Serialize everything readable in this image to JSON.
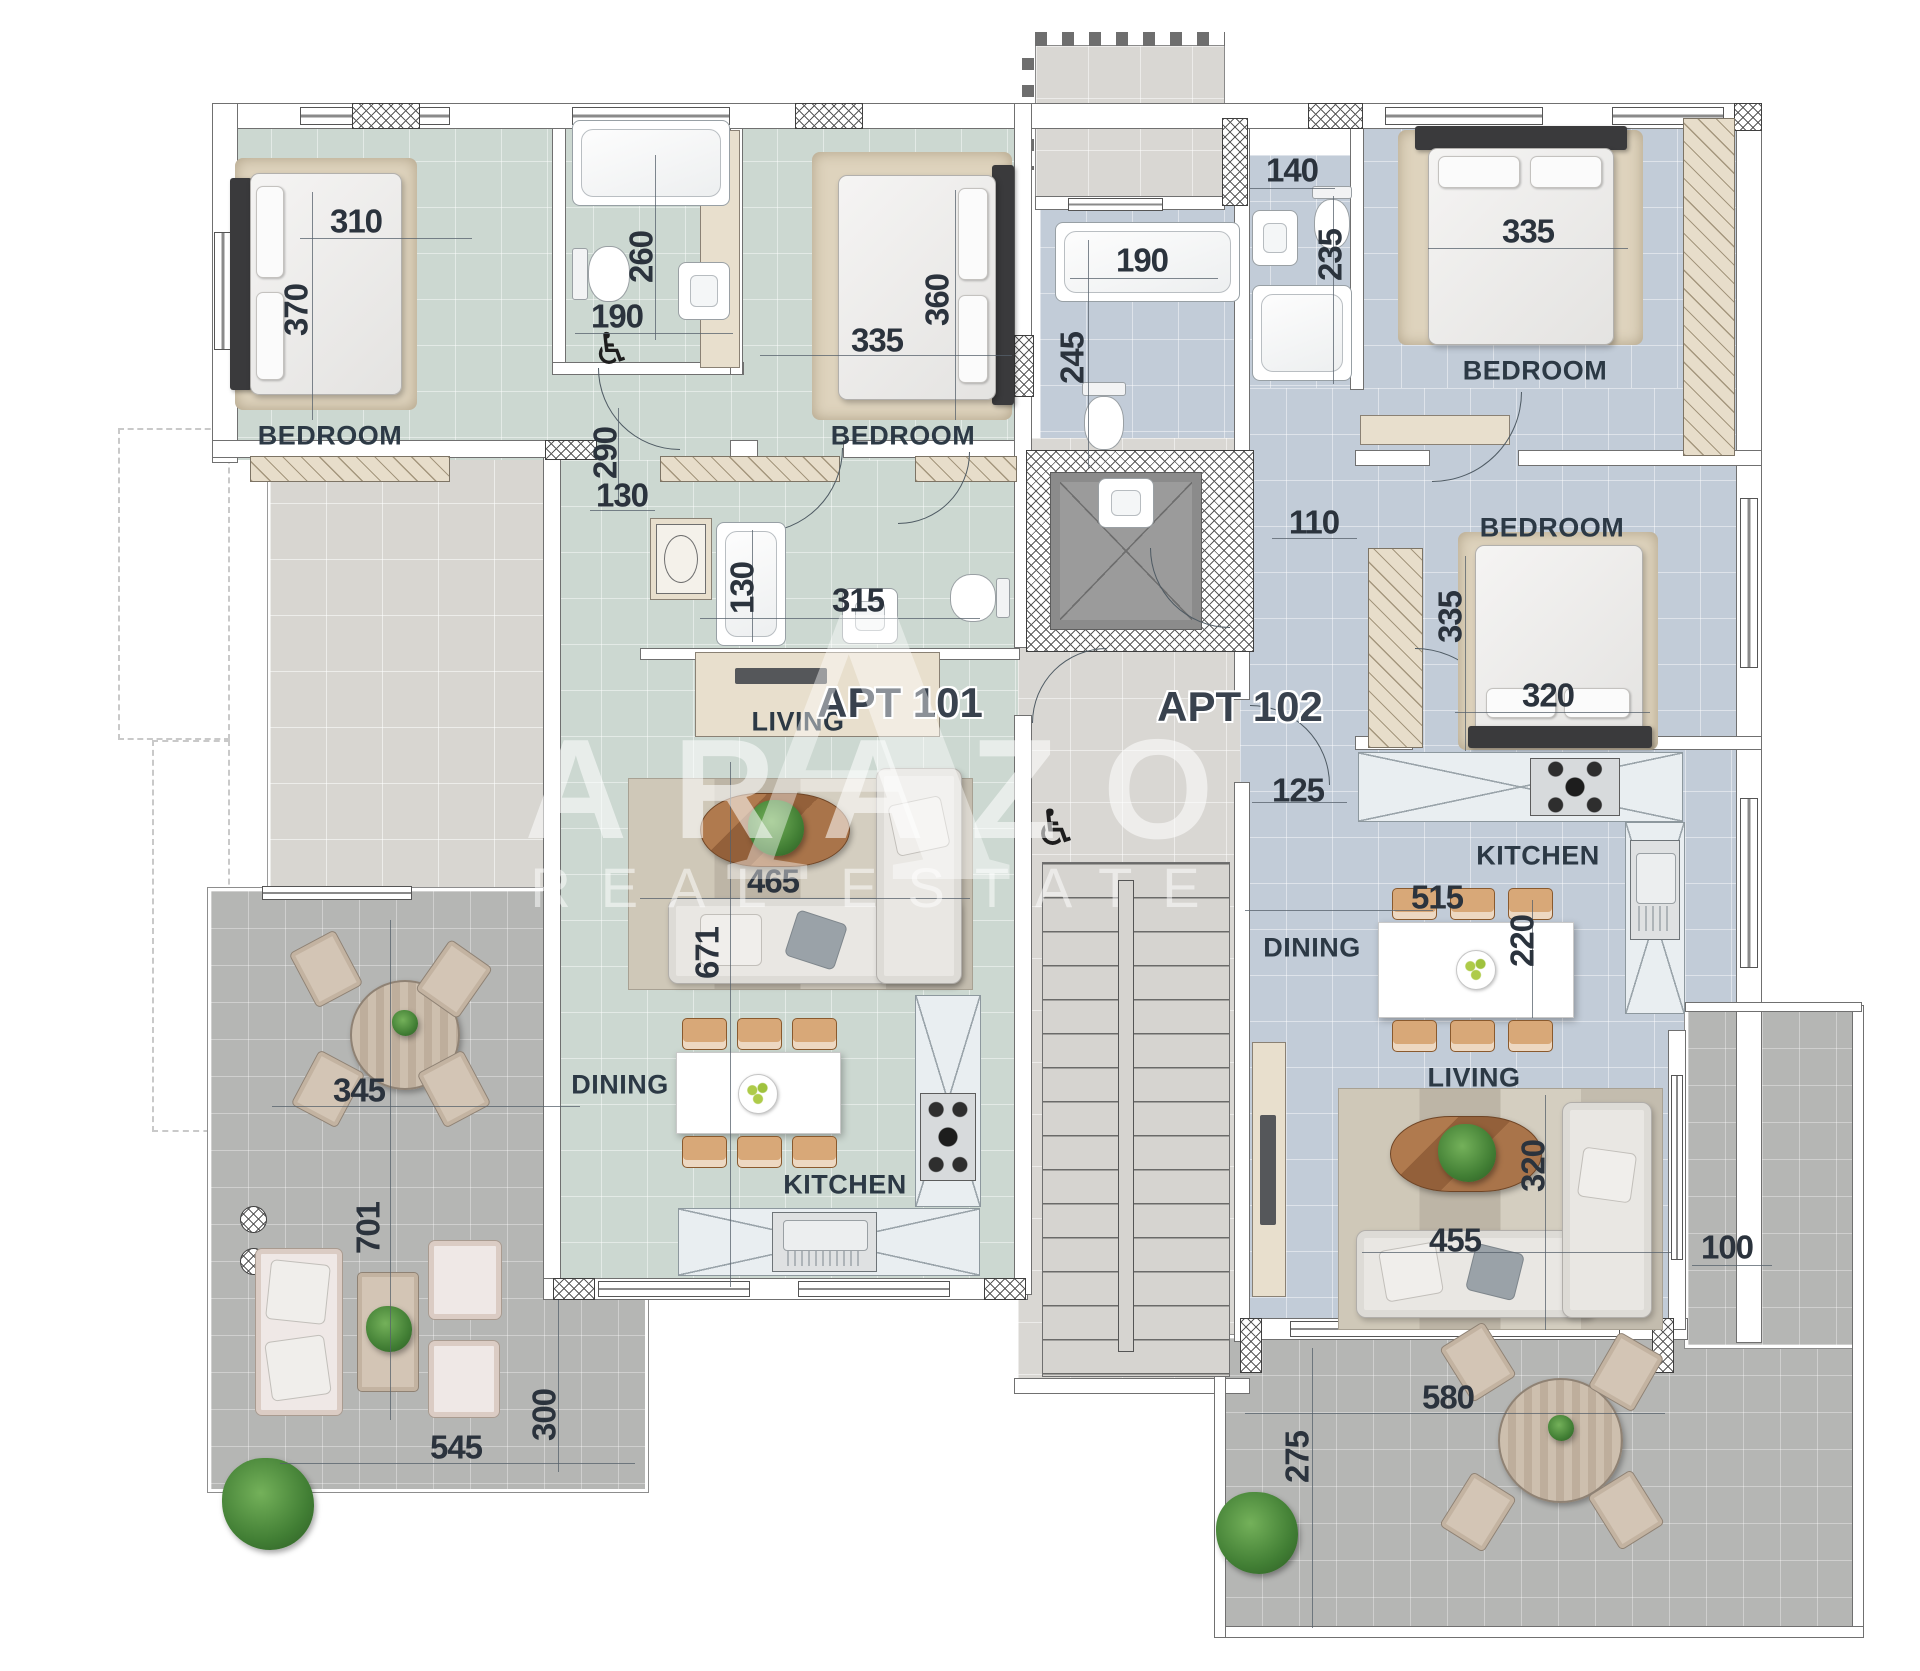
{
  "watermark": {
    "monogram": "A",
    "brand": "ARAZO",
    "tagline": "REAL ESTATE"
  },
  "apartments": {
    "apt101": "APT 101",
    "apt102": "APT 102"
  },
  "rooms": {
    "a101_bedroom1": "BEDROOM",
    "a101_bedroom2": "BEDROOM",
    "a101_living": "LIVING",
    "a101_dining": "DINING",
    "a101_kitchen": "KITCHEN",
    "a102_bedroom1": "BEDROOM",
    "a102_bedroom2": "BEDROOM",
    "a102_living": "LIVING",
    "a102_dining": "DINING",
    "a102_kitchen": "KITCHEN"
  },
  "dimensions": {
    "d310": "310",
    "d370": "370",
    "d260": "260",
    "d190a": "190",
    "d290": "290",
    "d130a": "130",
    "d335a": "335",
    "d360": "360",
    "d130b": "130",
    "d315": "315",
    "d465": "465",
    "d671": "671",
    "d345": "345",
    "d701": "701",
    "d545": "545",
    "d300": "300",
    "d190b": "190",
    "d245": "245",
    "d140": "140",
    "d235": "235",
    "d335b": "335",
    "d110": "110",
    "d335c": "335",
    "d320a": "320",
    "d125": "125",
    "d515": "515",
    "d220": "220",
    "d455": "455",
    "d320b": "320",
    "d100": "100",
    "d580": "580",
    "d275": "275"
  }
}
